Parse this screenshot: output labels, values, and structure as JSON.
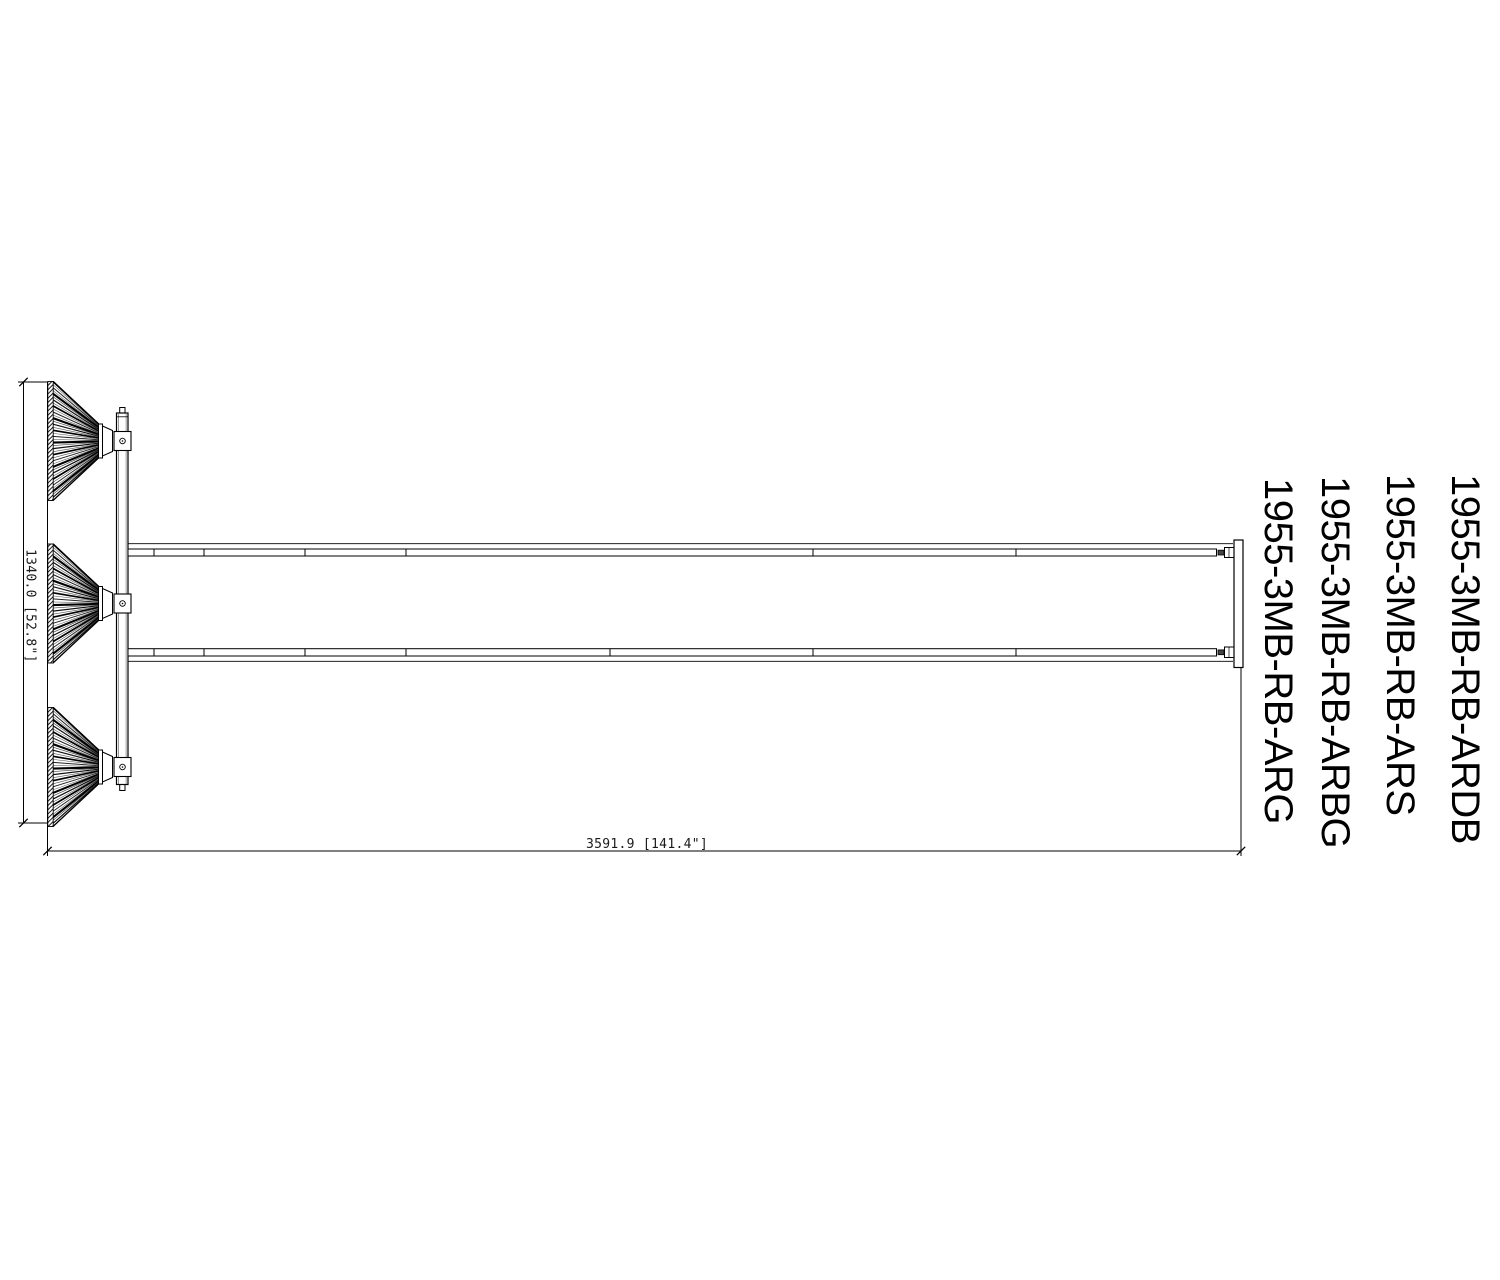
{
  "part_labels": [
    "1955-3MB-RB-ARG",
    "1955-3MB-RB-ARBG",
    "1955-3MB-RB-ARS",
    "1955-3MB-RB-ARDB"
  ],
  "dimensions": {
    "height": "1340.0 [52.8\"]",
    "length": "3591.9 [141.4\"]"
  },
  "colors": {
    "line": "#000000",
    "background": "#ffffff"
  }
}
